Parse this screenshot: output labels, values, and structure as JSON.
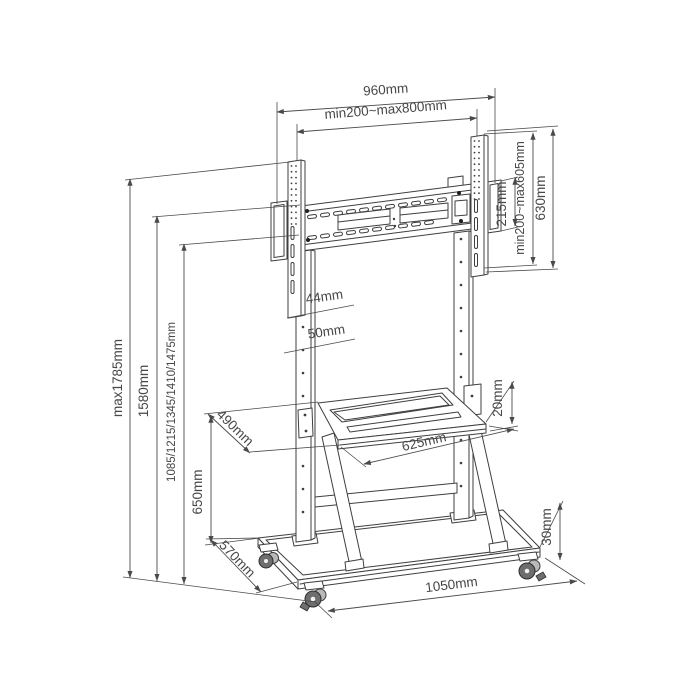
{
  "diagram": {
    "title": "Mobile TV floor stand dimensional drawing",
    "colors": {
      "line": "#3f3f3f",
      "text": "#474747",
      "background": "#ffffff"
    }
  },
  "dims": {
    "total_width": "960mm",
    "vesa_width": "min200~max800mm",
    "plate_height": "215mm",
    "vesa_height": "min200~max605mm",
    "bracket_height": "630mm",
    "hole_gap_small": "44mm",
    "hole_gap_large": "50mm",
    "height_max": "max1785mm",
    "height_upper": "1580mm",
    "height_levels": "1085/1215/1345/1410/1475mm",
    "shelf_height": "650mm",
    "shelf_depth": "490mm",
    "shelf_thickness": "20mm",
    "shelf_width": "625mm",
    "base_depth": "570mm",
    "base_thickness": "30mm",
    "base_width": "1050mm"
  }
}
